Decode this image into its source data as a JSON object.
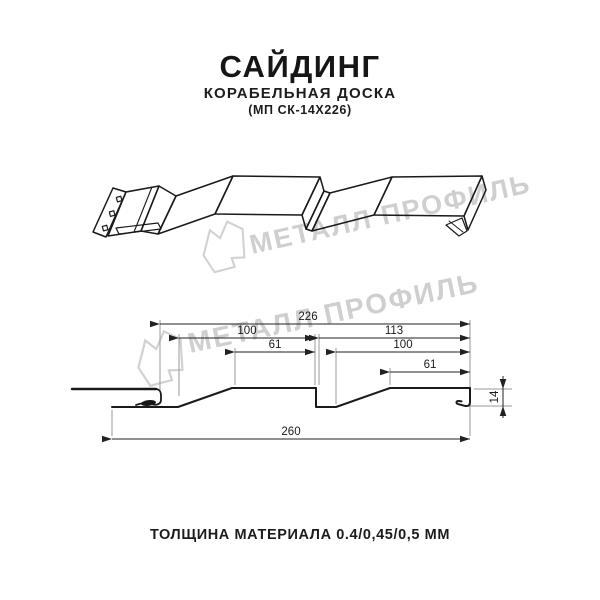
{
  "header": {
    "title": "САЙДИНГ",
    "subtitle": "КОРАБЕЛЬНАЯ ДОСКА",
    "product_code": "(МП СК-14Х226)"
  },
  "watermark": {
    "brand": "МЕТАЛЛ ПРОФИЛЬ",
    "color": "#cfcfcf"
  },
  "cross_section": {
    "dim_total_width": "226",
    "dim_board1_width": "100",
    "dim_board2_width": "113",
    "dim_board1_flat": "61",
    "dim_board2_slope": "100",
    "dim_board2_flat": "61",
    "dim_overall_width": "260",
    "dim_profile_height": "14"
  },
  "footer": {
    "thickness_note": "ТОЛЩИНА МАТЕРИАЛА 0.4/0,45/0,5 ММ"
  },
  "colors": {
    "line": "#1a1a1a",
    "dimension": "#222222",
    "extension": "#9a9a9a",
    "watermark": "#cfcfcf"
  }
}
